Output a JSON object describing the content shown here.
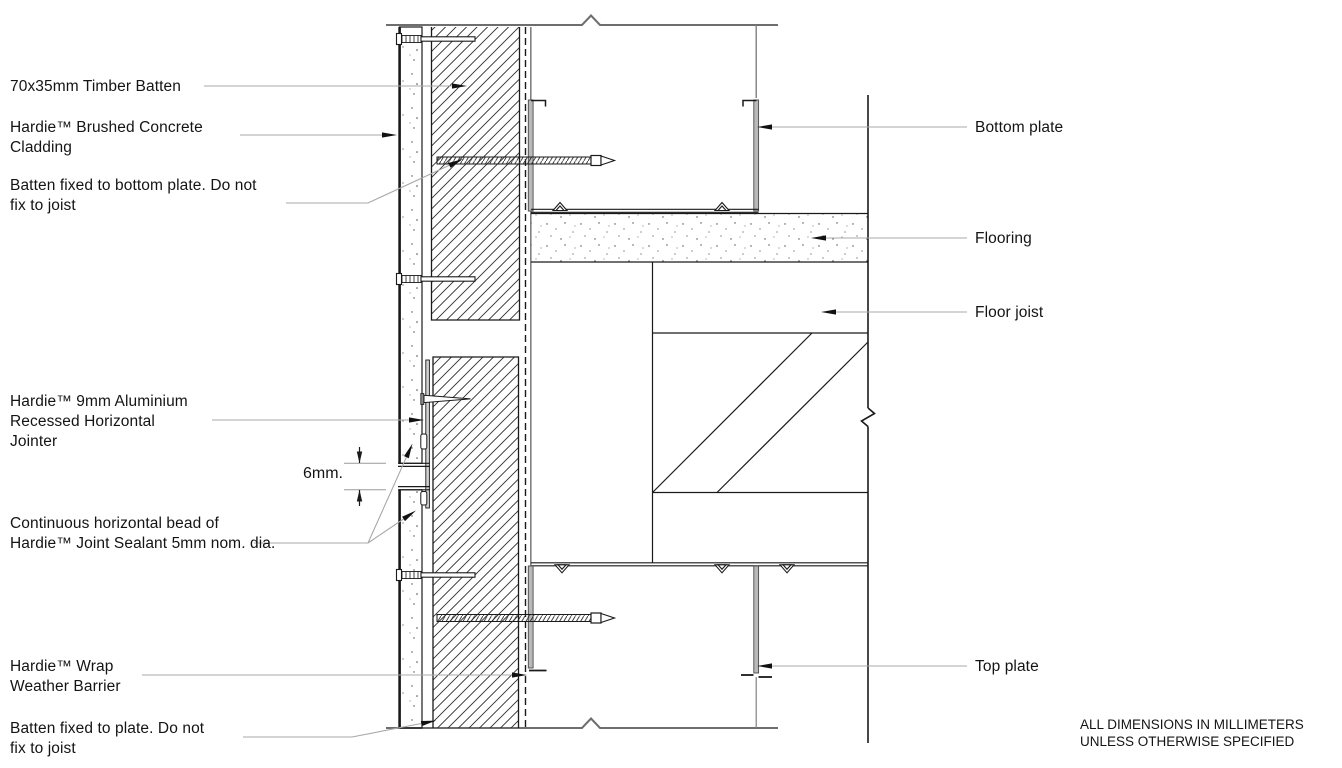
{
  "drawing_type": "construction-section-detail",
  "labels": {
    "timber_batten": "70x35mm Timber Batten",
    "cladding": "Hardie™ Brushed Concrete\nCladding",
    "batten_fixed_bottom": "Batten fixed to bottom plate. Do not\nfix to joist",
    "jointer": "Hardie™ 9mm Aluminium\nRecessed Horizontal\nJointer",
    "dimension_6mm": "6mm.",
    "sealant": "Continuous horizontal bead of\nHardie™ Joint Sealant 5mm nom. dia.",
    "wrap": "Hardie™ Wrap\nWeather Barrier",
    "batten_fixed_plate": "Batten fixed to plate. Do not\nfix to joist",
    "bottom_plate": "Bottom plate",
    "flooring": "Flooring",
    "floor_joist": "Floor joist",
    "top_plate": "Top plate",
    "note": "ALL DIMENSIONS IN MILLIMETERS\nUNLESS OTHERWISE SPECIFIED"
  },
  "colors": {
    "line": "#1a1a1a",
    "cut_line": "#6e6e6e",
    "leader": "#a8a8a8",
    "steel_fill": "#b9b9b9",
    "background": "#ffffff"
  }
}
